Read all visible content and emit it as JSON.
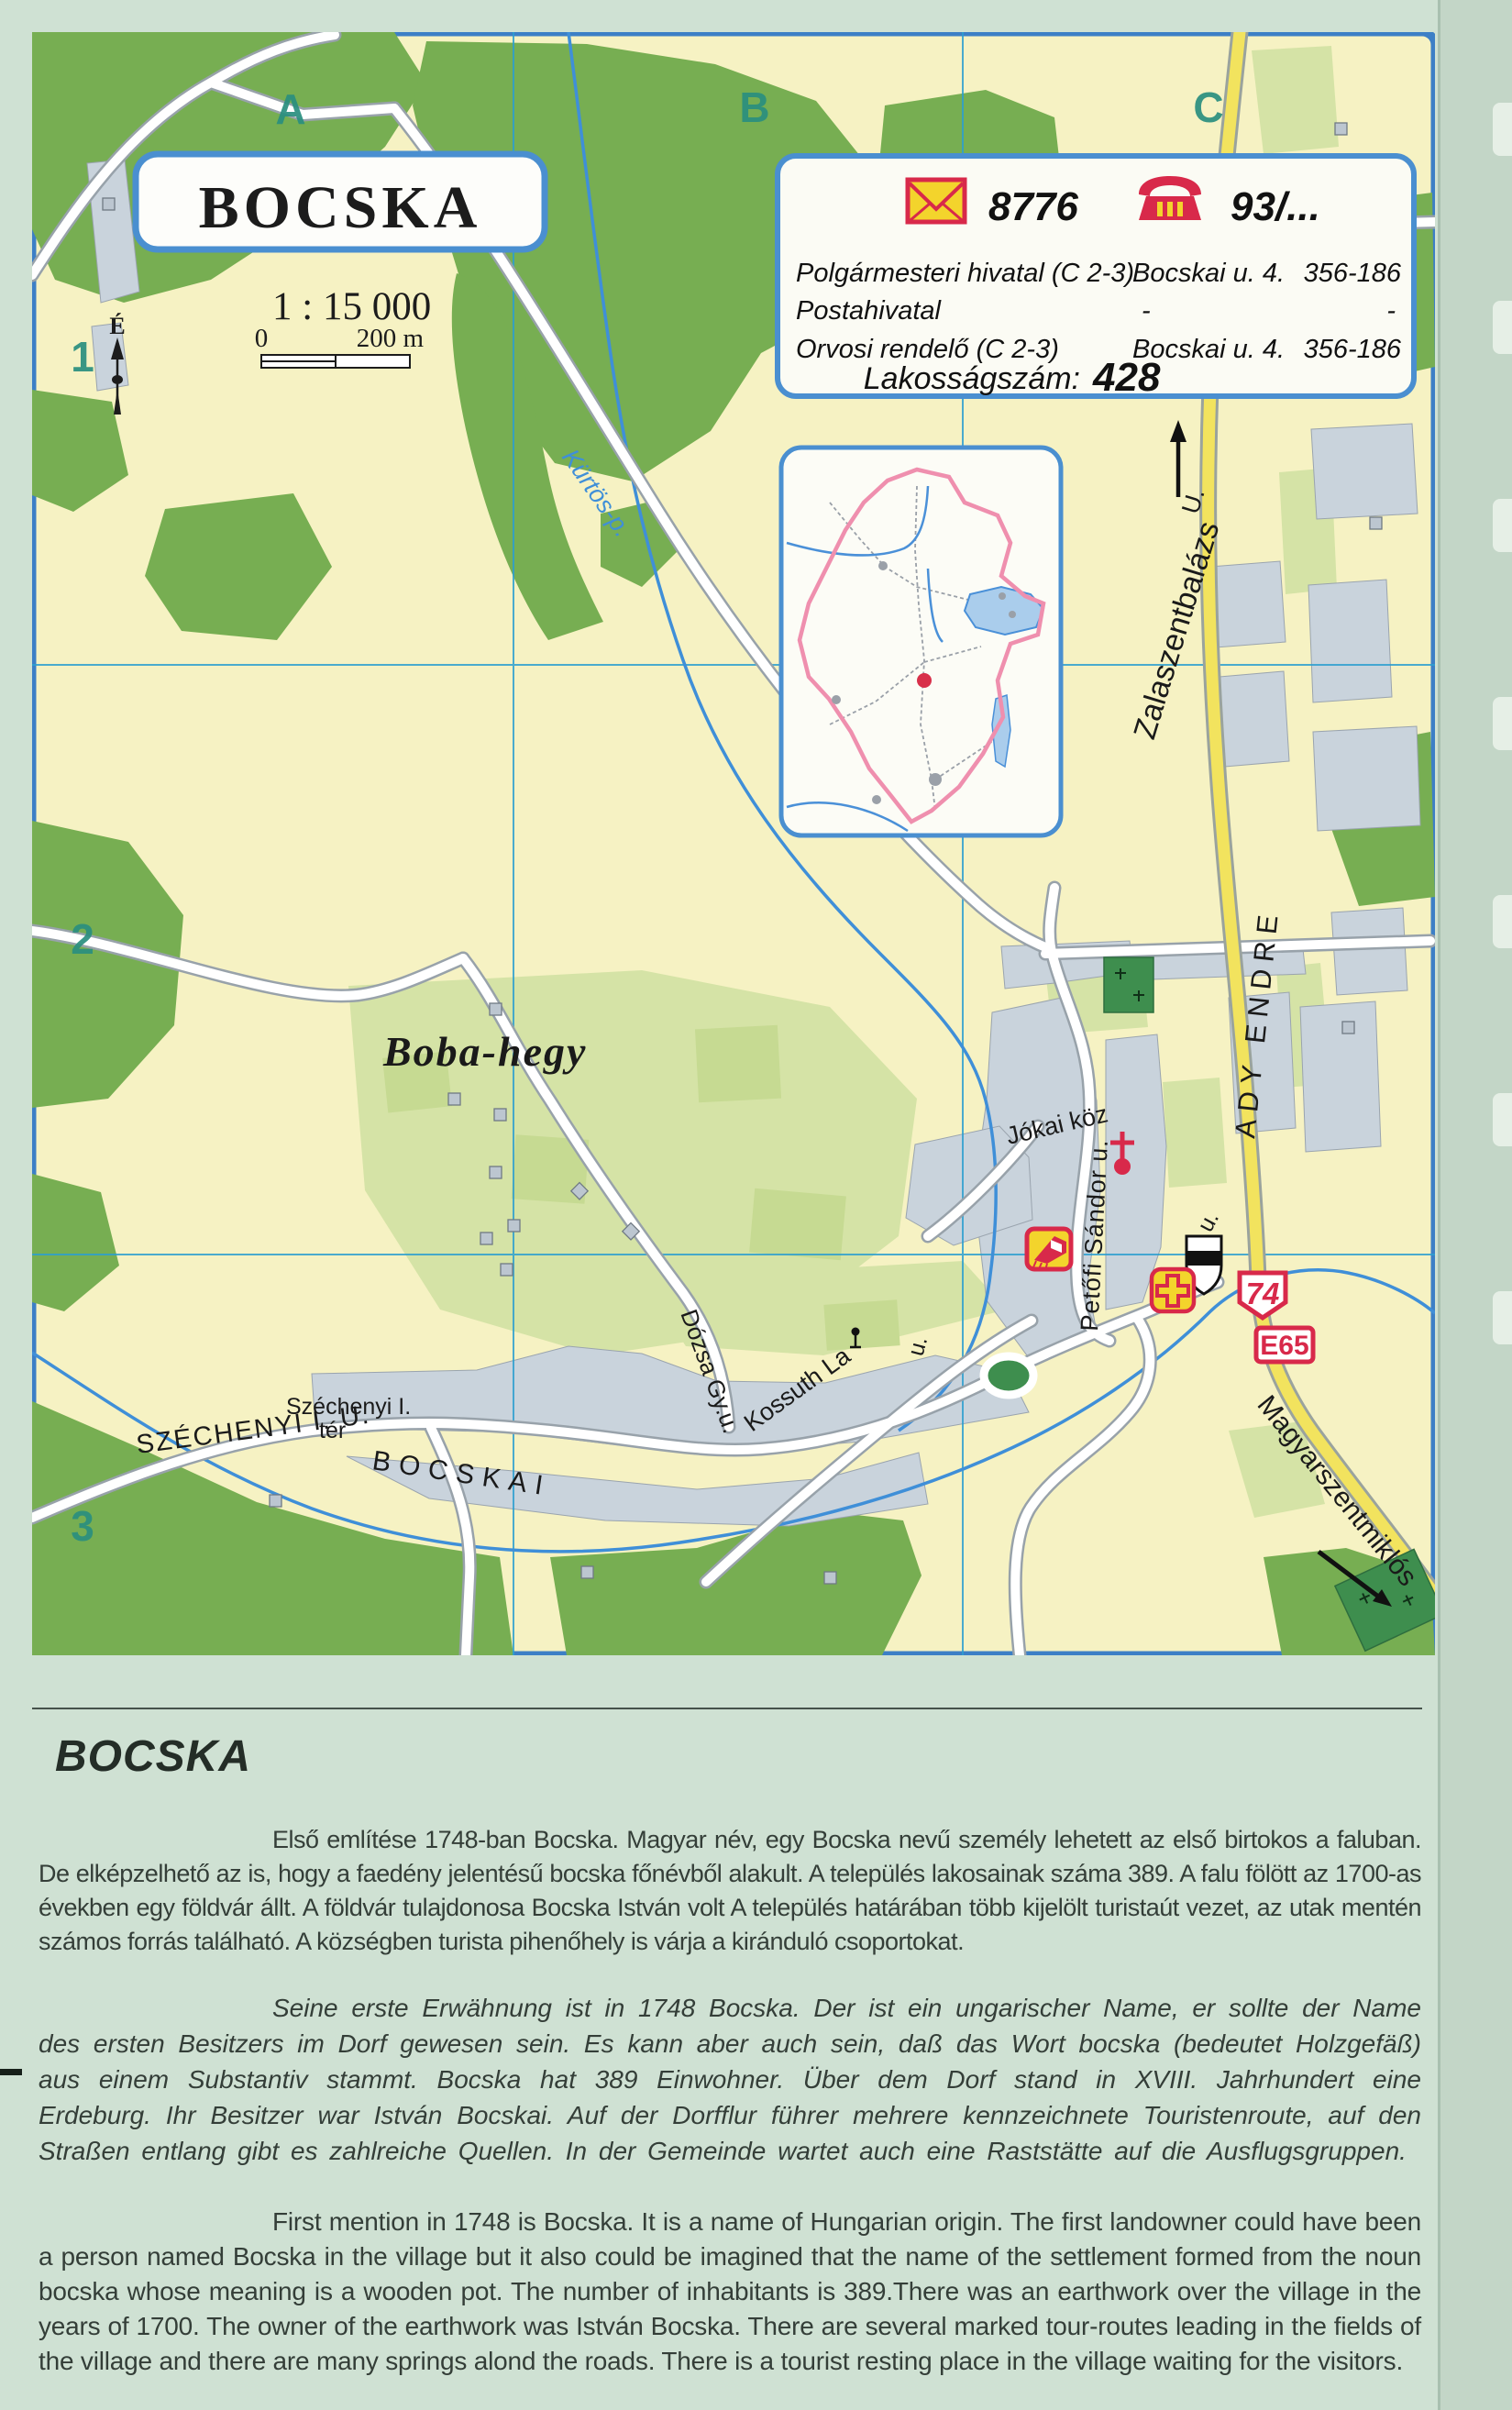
{
  "map": {
    "title": "BOCSKA",
    "scale": {
      "ratio": "1 : 15 000",
      "zero": "0",
      "end": "200 m"
    },
    "north": "É",
    "grid": {
      "cols": [
        "A",
        "B",
        "C"
      ],
      "rows": [
        "1",
        "2",
        "3"
      ]
    },
    "info": {
      "postal_code": "8776",
      "phone_code": "93/...",
      "rows": [
        {
          "name": "Polgármesteri hivatal (C 2-3)",
          "address": "Bocskai u. 4.",
          "phone": "356-186"
        },
        {
          "name": "Postahivatal",
          "address": "-",
          "phone": "-"
        },
        {
          "name": "Orvosi rendelő (C 2-3)",
          "address": "Bocskai u. 4.",
          "phone": "356-186"
        }
      ],
      "population_label": "Lakosságszám:",
      "population_value": "428"
    },
    "labels": {
      "hill": "Boba-hegy",
      "stream": "Kürtös-p.",
      "dest_north": "Zalaszentbalázs",
      "dest_north_suffix": "U.",
      "dest_south": "Magyarszentmiklós",
      "street_ady": "ADY ENDRE",
      "street_jokai": "Jókai köz",
      "street_petofi": "Petőfi Sándor u.",
      "street_kossuth": "Kossuth La",
      "street_kossuth_suffix": "u.",
      "street_u2": "u.",
      "street_dozsa": "Dózsa Gy.u.",
      "street_szechenyi": "SZÉCHENYI I. U.",
      "square_line1": "Széchenyi I.",
      "square_line2": "tér",
      "street_bocskai": "BOCSKAI",
      "road_number": "74",
      "road_euro": "E65"
    }
  },
  "article": {
    "heading": "BOCSKA",
    "hu": "Első említése 1748-ban Bocska. Magyar név, egy Bocska nevű személy lehetett az első birtokos a faluban. De elképzelhető az is, hogy a faedény jelentésű bocska főnévből alakult. A település lakosainak száma 389. A falu fölött az 1700-as években egy földvár állt. A földvár tulajdonosa Bocska István volt A település határában több kijelölt turistaút vezet, az utak mentén számos forrás található. A községben turista pihenőhely is várja a kiránduló csoportokat.",
    "de": "Seine erste Erwähnung ist in 1748 Bocska. Der ist ein ungarischer Name, er sollte der Name des ersten Besitzers im Dorf gewesen sein. Es kann aber auch sein, daß das Wort bocska (bedeutet Holzgefäß) aus einem Substantiv stammt. Bocska hat 389 Einwohner. Über dem Dorf stand in XVIII. Jahrhundert eine Erdeburg. Ihr Besitzer war István Bocskai. Auf der Dorfflur führer mehrere kennzeichnete Touristenroute, auf den Straßen entlang gibt es zahlreiche Quellen. In der Gemeinde wartet auch eine Raststätte auf die Ausflugsgruppen.",
    "en": "First mention in 1748 is Bocska. It is a name of Hungarian origin. The first landowner could have been a person named Bocska in the village but it also could be imagined that the name of the settlement formed from the noun bocska whose meaning is a wooden pot. The number of inhabitants is 389.There was an earthwork over the village in the years of 1700. The owner of the earthwork was István Bocska. There are several marked tour-routes leading in the fields of the village and there are many springs alond the roads. There is a tourist resting place in the village waiting for the visitors."
  },
  "colors": {
    "page_bg": "#cfe1d3",
    "map_bg": "#f6f2c3",
    "map_border": "#3c7fc6",
    "forest": "#77ae52",
    "field": "#d5e3a6",
    "builtup": "#c9d3dc",
    "road_yellow": "#f2e35e",
    "water": "#3f8fd8",
    "grid_line": "#2d9fd0",
    "sign_red": "#d8294a",
    "icon_yellow": "#f3d42c",
    "grid_label": "#2a8f7f",
    "cemetery_green": "#3e8e4e"
  }
}
